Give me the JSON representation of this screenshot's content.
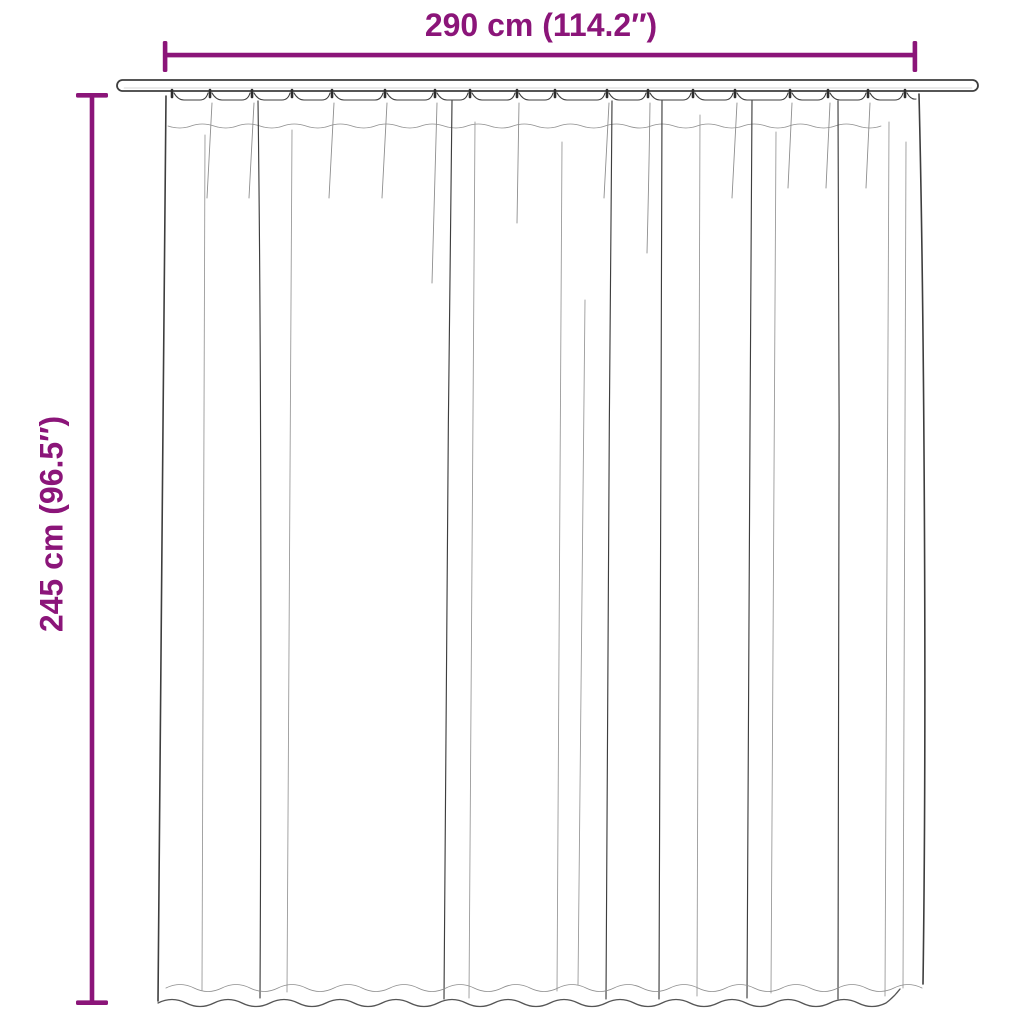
{
  "diagram": {
    "type": "product-dimension-diagram",
    "product": "pleated curtain hanging on a rod",
    "width_label": "290 cm (114.2″)",
    "height_label": "245 cm (96.5″)",
    "width_cm": 290,
    "width_inches": 114.2,
    "height_cm": 245,
    "height_inches": 96.5,
    "accent_color": "#8B1579",
    "line_color": "#3E3E3E",
    "background_color": "#FFFFFF"
  }
}
